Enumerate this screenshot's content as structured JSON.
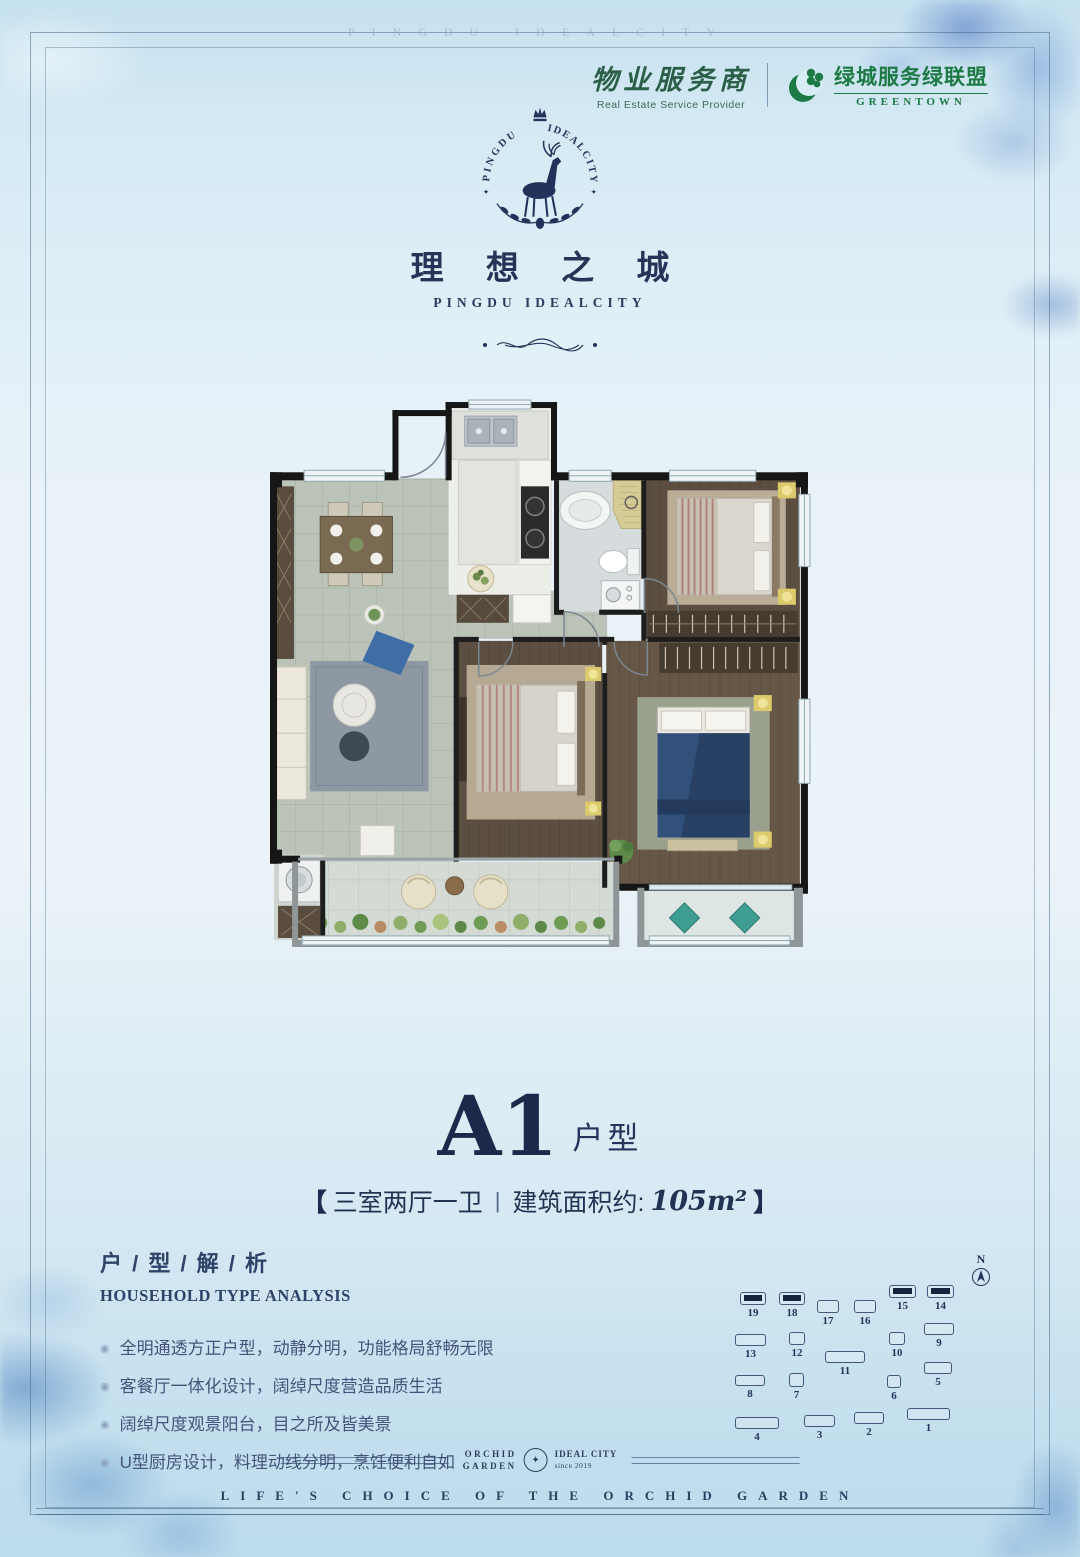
{
  "watermark": "PINGDU IDEALCITY",
  "colors": {
    "background_top": "#c6e1ef",
    "background_mid": "#ebf3f8",
    "navy": "#22325a",
    "navy_dark": "#1b2a4a",
    "green": "#1e7a44",
    "watercolor_blue": "#5a8cc3",
    "building_highlight": "#16243f",
    "wall_black": "#161616"
  },
  "header": {
    "provider_cn": "物业服务商",
    "provider_en": "Real Estate Service Provider",
    "greentown_cn": "绿城服务绿联盟",
    "greentown_en": "GREENTOWN"
  },
  "brand": {
    "arc_left": "PINGDU",
    "arc_right": "IDEALCITY",
    "name_cn": "理 想 之 城",
    "name_en": "PINGDU IDEALCITY"
  },
  "unit": {
    "code": "A1",
    "suffix": "户型",
    "bracket_left": "【",
    "bracket_right": "】",
    "rooms": "三室两厅一卫",
    "separator": "|",
    "area_label": "建筑面积约:",
    "area_value": "105m²"
  },
  "analysis": {
    "title_cn": "户 / 型 / 解 / 析",
    "title_en": "HOUSEHOLD TYPE ANALYSIS",
    "bullet_icon": "◉",
    "bullets": [
      "全明通透方正户型，动静分明，功能格局舒畅无限",
      "客餐厅一体化设计，阔绰尺度营造品质生活",
      "阔绰尺度观景阳台，目之所及皆美景",
      "U型厨房设计，料理动线分明，烹饪便利自如"
    ]
  },
  "site_plan": {
    "north_label": "N",
    "buildings": [
      {
        "n": "19",
        "x": 28,
        "y": 40,
        "w": 26,
        "h": 13,
        "hl": true
      },
      {
        "n": "18",
        "x": 67,
        "y": 40,
        "w": 26,
        "h": 13,
        "hl": true
      },
      {
        "n": "17",
        "x": 105,
        "y": 48,
        "w": 22,
        "h": 13,
        "hl": false
      },
      {
        "n": "16",
        "x": 142,
        "y": 48,
        "w": 22,
        "h": 13,
        "hl": false
      },
      {
        "n": "15",
        "x": 177,
        "y": 33,
        "w": 27,
        "h": 13,
        "hl": true
      },
      {
        "n": "14",
        "x": 215,
        "y": 33,
        "w": 27,
        "h": 13,
        "hl": true
      },
      {
        "n": "13",
        "x": 23,
        "y": 82,
        "w": 31,
        "h": 12,
        "hl": false
      },
      {
        "n": "12",
        "x": 77,
        "y": 80,
        "w": 16,
        "h": 13,
        "hl": false
      },
      {
        "n": "11",
        "x": 113,
        "y": 99,
        "w": 40,
        "h": 12,
        "hl": false
      },
      {
        "n": "10",
        "x": 177,
        "y": 80,
        "w": 16,
        "h": 13,
        "hl": false
      },
      {
        "n": "9",
        "x": 212,
        "y": 71,
        "w": 30,
        "h": 12,
        "hl": false
      },
      {
        "n": "8",
        "x": 23,
        "y": 123,
        "w": 30,
        "h": 11,
        "hl": false
      },
      {
        "n": "7",
        "x": 77,
        "y": 121,
        "w": 15,
        "h": 14,
        "hl": false
      },
      {
        "n": "6",
        "x": 175,
        "y": 123,
        "w": 14,
        "h": 13,
        "hl": false
      },
      {
        "n": "5",
        "x": 212,
        "y": 110,
        "w": 28,
        "h": 12,
        "hl": false
      },
      {
        "n": "4",
        "x": 23,
        "y": 165,
        "w": 44,
        "h": 12,
        "hl": false
      },
      {
        "n": "3",
        "x": 92,
        "y": 163,
        "w": 31,
        "h": 12,
        "hl": false
      },
      {
        "n": "2",
        "x": 142,
        "y": 160,
        "w": 30,
        "h": 12,
        "hl": false
      },
      {
        "n": "1",
        "x": 195,
        "y": 156,
        "w": 43,
        "h": 12,
        "hl": false
      }
    ]
  },
  "footer": {
    "badge_left_1": "ORCHID",
    "badge_left_2": "GARDEN",
    "badge_right_1": "IDEAL CITY",
    "badge_right_2": "since 2019",
    "badge_icon": "✦",
    "tagline": "LIFE'S CHOICE OF THE ORCHID GARDEN"
  }
}
